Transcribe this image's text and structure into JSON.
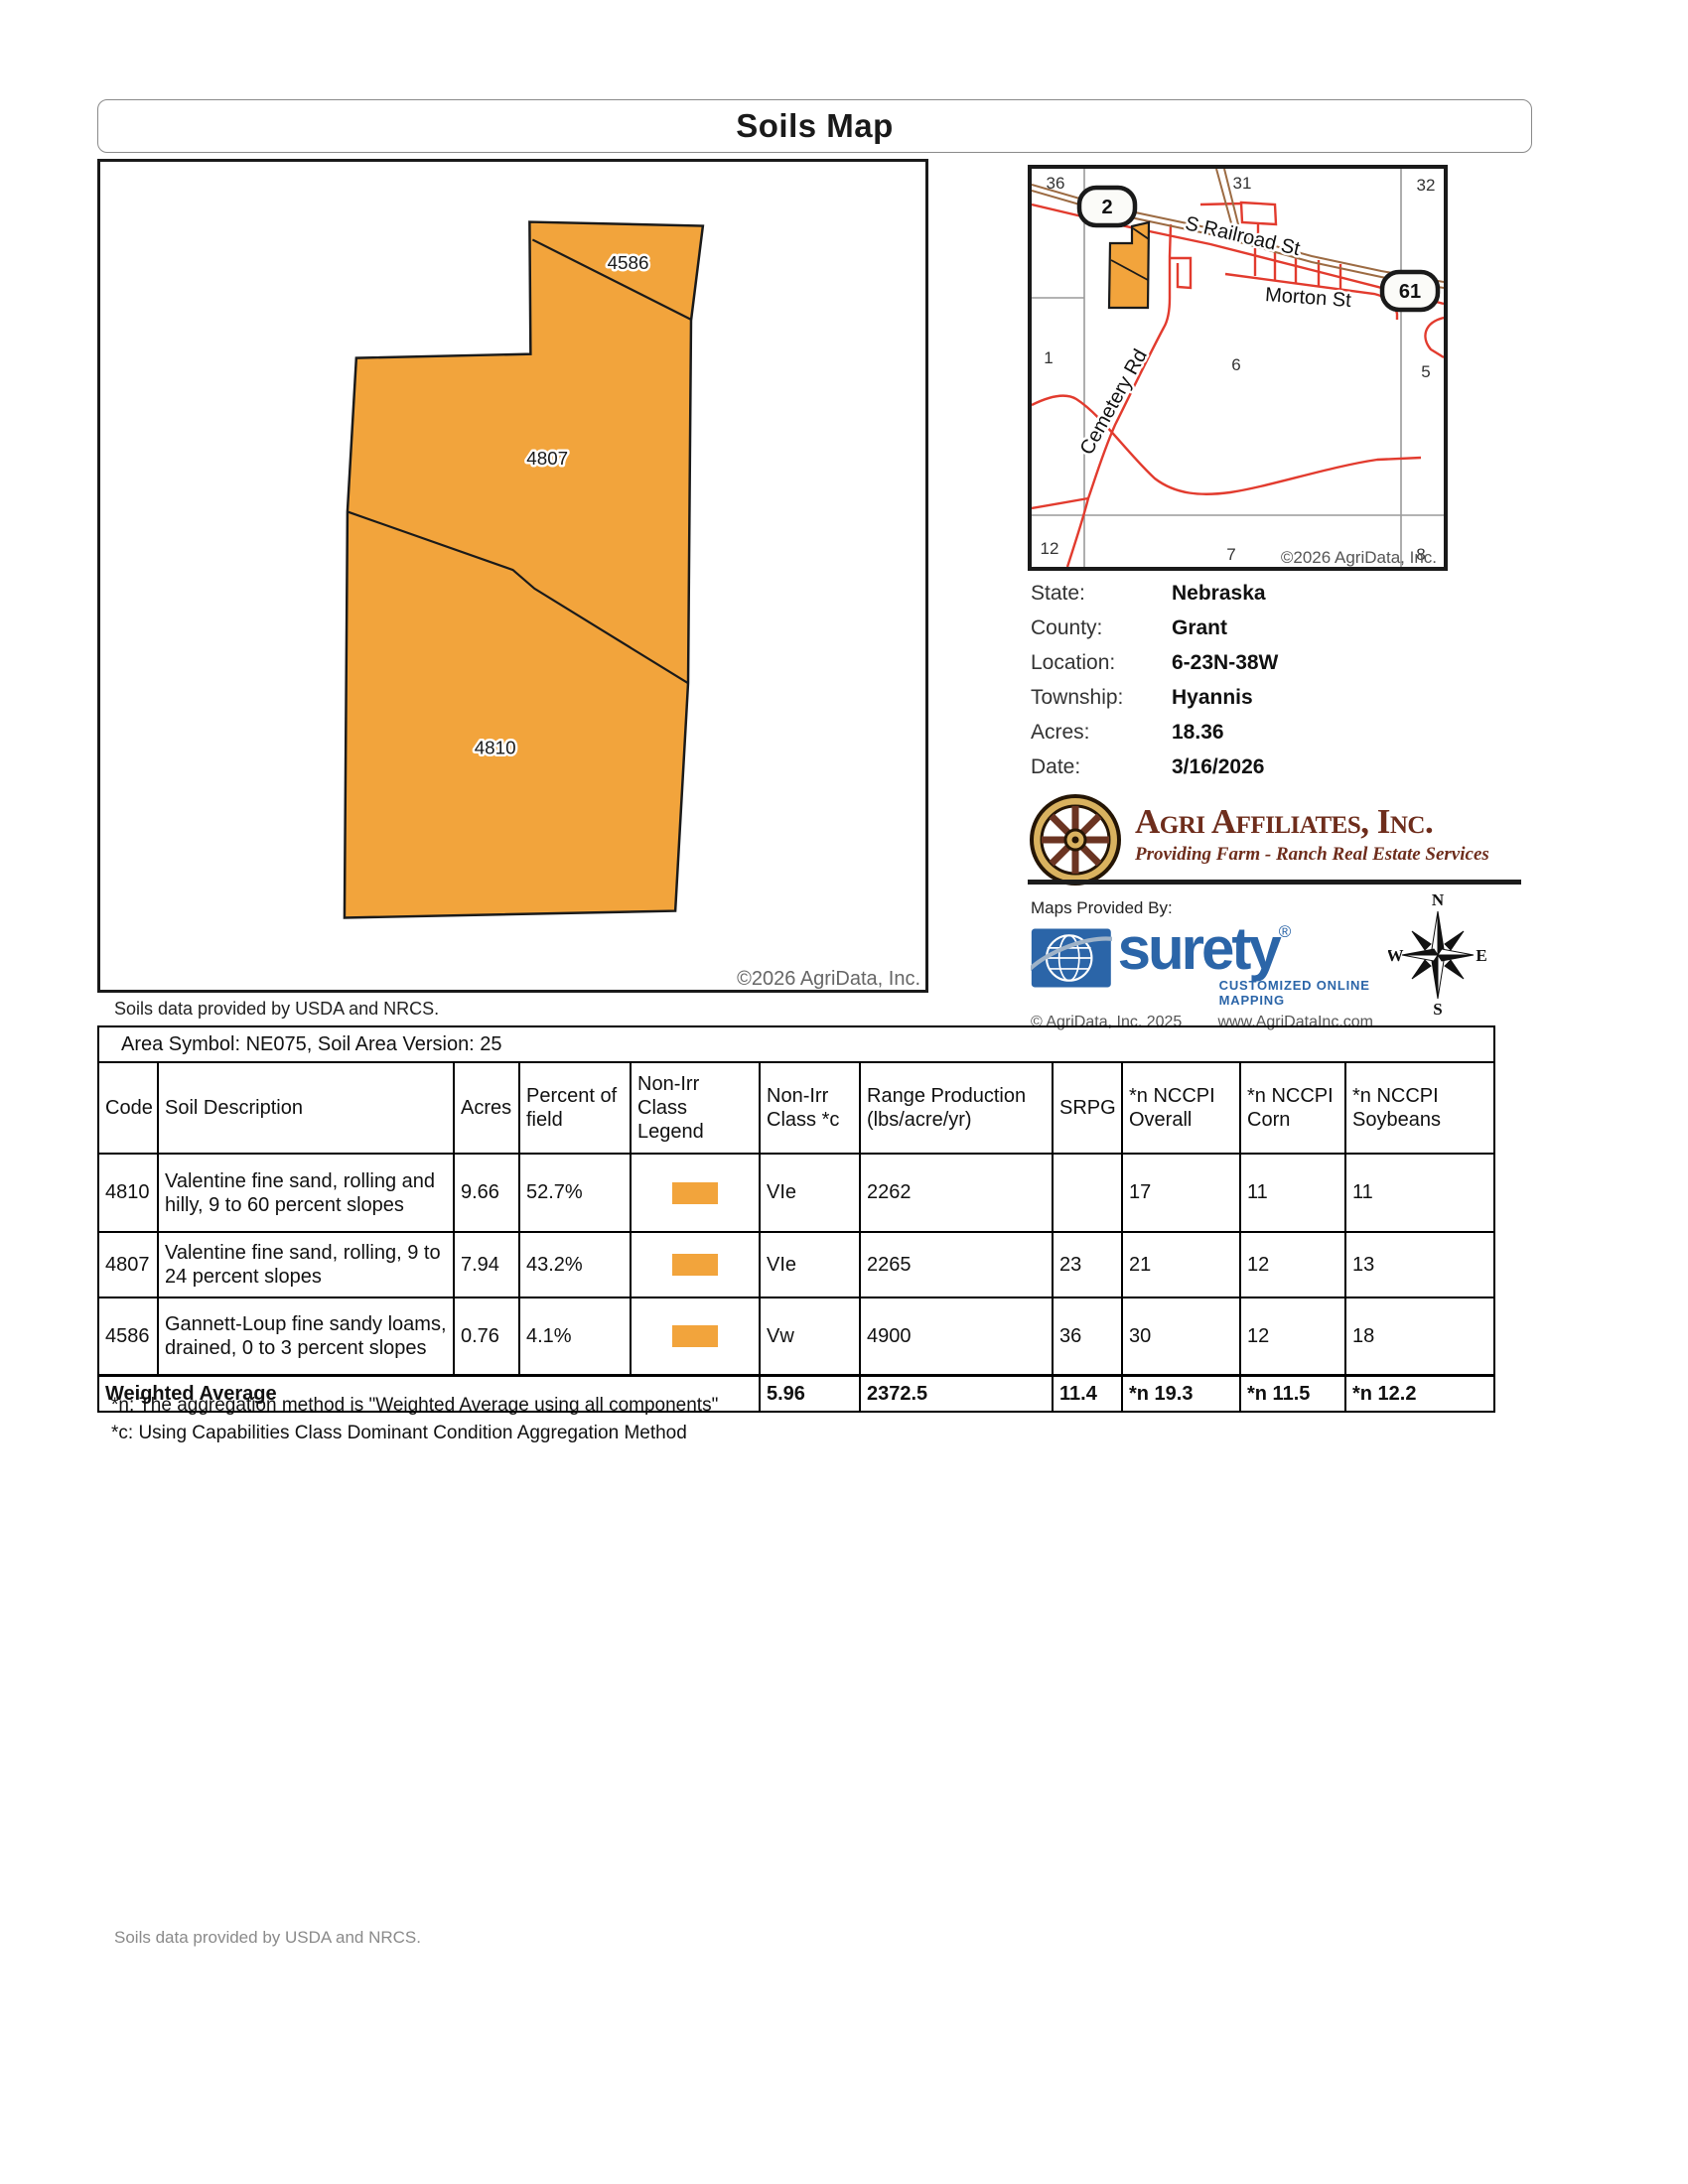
{
  "title": "Soils Map",
  "colors": {
    "soil_fill": "#F2A43C",
    "surety_blue": "#2B65A8",
    "logo_maroon": "#6E2D1C",
    "road_red": "#E23B2E",
    "railroad_brown": "#9C6B43",
    "section_line_gray": "#9A9A9A"
  },
  "main_map": {
    "labels": {
      "top": "4586",
      "middle": "4807",
      "bottom": "4810"
    },
    "copyright": "©2026 AgriData, Inc.",
    "source_note": "Soils data provided by USDA and NRCS."
  },
  "locator_map": {
    "sections": {
      "s36": "36",
      "s31": "31",
      "s32": "32",
      "s1": "1",
      "s6": "6",
      "s5": "5",
      "s12": "12",
      "s7": "7",
      "s8": "8"
    },
    "roads": {
      "railroad": "S Railroad St",
      "morton": "Morton St",
      "cemetery": "Cemetery Rd"
    },
    "highways": {
      "h2": "2",
      "h61": "61"
    },
    "copyright": "©2026 AgriData, Inc."
  },
  "info": {
    "rows": [
      {
        "label": "State:",
        "value": "Nebraska"
      },
      {
        "label": "County:",
        "value": "Grant"
      },
      {
        "label": "Location:",
        "value": "6-23N-38W"
      },
      {
        "label": "Township:",
        "value": "Hyannis"
      },
      {
        "label": "Acres:",
        "value": "18.36"
      },
      {
        "label": "Date:",
        "value": "3/16/2026"
      }
    ]
  },
  "agri_logo": {
    "name": "Agri Affiliates, Inc.",
    "tagline": "Providing Farm - Ranch Real Estate Services"
  },
  "surety": {
    "provided_by": "Maps Provided By:",
    "brand": "surety",
    "registered": "®",
    "subtitle": "CUSTOMIZED ONLINE MAPPING",
    "copyright": "© AgriData, Inc. 2025",
    "website": "www.AgriDataInc.com"
  },
  "compass": {
    "n": "N",
    "e": "E",
    "s": "S",
    "w": "W"
  },
  "soil_table": {
    "area_header": "Area Symbol: NE075, Soil Area Version: 25",
    "headers": {
      "code": "Code",
      "description": "Soil Description",
      "acres": "Acres",
      "percent": "Percent of field",
      "legend": "Non-Irr Class Legend",
      "class": "Non-Irr Class *c",
      "range": "Range Production (lbs/acre/yr)",
      "srpg": "SRPG",
      "overall": "*n NCCPI Overall",
      "corn": "*n NCCPI Corn",
      "soybeans": "*n NCCPI Soybeans"
    },
    "rows": [
      {
        "code": "4810",
        "description": "Valentine fine sand, rolling and hilly, 9 to 60 percent slopes",
        "acres": "9.66",
        "percent": "52.7%",
        "class": "VIe",
        "range": "2262",
        "srpg": "",
        "overall": "17",
        "corn": "11",
        "soybeans": "11"
      },
      {
        "code": "4807",
        "description": "Valentine fine sand, rolling, 9 to 24 percent slopes",
        "acres": "7.94",
        "percent": "43.2%",
        "class": "VIe",
        "range": "2265",
        "srpg": "23",
        "overall": "21",
        "corn": "12",
        "soybeans": "13"
      },
      {
        "code": "4586",
        "description": "Gannett-Loup fine sandy loams, drained, 0 to 3 percent slopes",
        "acres": "0.76",
        "percent": "4.1%",
        "class": "Vw",
        "range": "4900",
        "srpg": "36",
        "overall": "30",
        "corn": "12",
        "soybeans": "18"
      }
    ],
    "weighted": {
      "label": "Weighted Average",
      "class": "5.96",
      "range": "2372.5",
      "srpg": "11.4",
      "overall": "*n 19.3",
      "corn": "*n 11.5",
      "soybeans": "*n 12.2"
    }
  },
  "footnotes": {
    "n": "*n: The aggregation method is \"Weighted Average using all components\"",
    "c": "*c: Using Capabilities Class Dominant Condition Aggregation Method"
  },
  "footer": {
    "source_note": "Soils data provided by USDA and NRCS."
  }
}
